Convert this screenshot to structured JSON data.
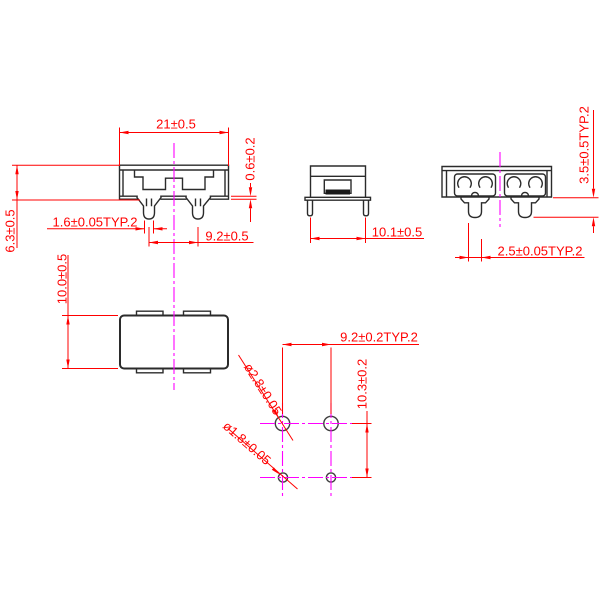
{
  "drawing": {
    "title": "component-dimension-drawing",
    "front_view": {
      "body_width": "21±0.5",
      "base_thickness": "0.6±0.2",
      "body_height": "6.3±0.5",
      "pin_width": "1.6±0.05TYP.2",
      "pin_pitch": "9.2±0.5"
    },
    "side_view": {
      "body_depth": "10.1±0.5"
    },
    "end_view": {
      "pin_protrusion": "3.5±0.5TYP.2",
      "pin_thickness": "2.5±0.05TYP.2"
    },
    "top_view": {
      "body_depth": "10.0±0.5"
    },
    "hole_pattern": {
      "hole_pitch_x": "9.2±0.2TYP.2",
      "hole_pitch_y": "10.3±0.2",
      "large_hole_dia": "ø2.8±0.05",
      "small_hole_dia": "ø1.8±0.05"
    },
    "colors": {
      "dimension_red": "#ff0000",
      "centerline_magenta": "#ff00ff",
      "outline_black": "#2b2b2b"
    }
  }
}
